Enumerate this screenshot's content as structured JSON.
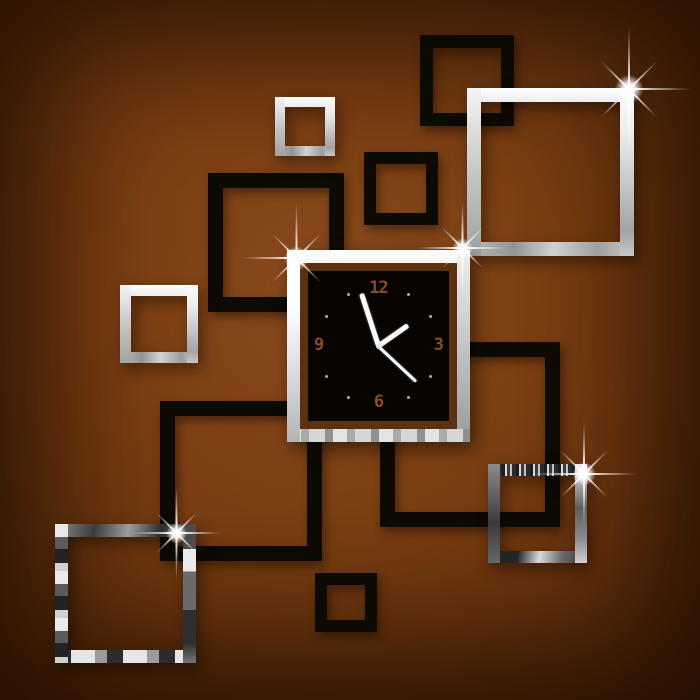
{
  "colors": {
    "wall_center": "#8a4a1d",
    "wall_corner": "#48220a",
    "black_frame": "#0d0903",
    "clock_face": "#080402",
    "clock_ring": "#5c3110",
    "digit": "#8e4c24",
    "hand": "#ffffff",
    "mirror_bright": "#ffffff",
    "mirror_mid": "#a8a8a8",
    "mirror_dark": "#2f2f2f"
  },
  "squares": [
    {
      "name": "black-square-top",
      "type": "black",
      "x": 420,
      "y": 35,
      "w": 94,
      "h": 91,
      "border": 13
    },
    {
      "name": "black-square-upper-mid",
      "type": "black",
      "x": 364,
      "y": 152,
      "w": 74,
      "h": 73,
      "border": 12
    },
    {
      "name": "black-square-left",
      "type": "black",
      "x": 208,
      "y": 173,
      "w": 136,
      "h": 139,
      "border": 15
    },
    {
      "name": "black-square-lower-left",
      "type": "black",
      "x": 160,
      "y": 401,
      "w": 162,
      "h": 160,
      "border": 15
    },
    {
      "name": "black-square-lower-right",
      "type": "black",
      "x": 380,
      "y": 342,
      "w": 180,
      "h": 185,
      "border": 15
    },
    {
      "name": "black-square-bottom-small",
      "type": "black",
      "x": 315,
      "y": 573,
      "w": 62,
      "h": 59,
      "border": 12
    },
    {
      "name": "mirror-square-small-top",
      "type": "mirror-light",
      "x": 275,
      "y": 97,
      "w": 60,
      "h": 59,
      "border": 10
    },
    {
      "name": "mirror-square-large",
      "type": "mirror-light",
      "x": 467,
      "y": 88,
      "w": 167,
      "h": 168,
      "border": 14
    },
    {
      "name": "mirror-square-left",
      "type": "mirror-light",
      "x": 120,
      "y": 285,
      "w": 78,
      "h": 78,
      "border": 11
    },
    {
      "name": "mirror-square-bottom-left",
      "type": "mirror-dark-a",
      "x": 55,
      "y": 524,
      "w": 141,
      "h": 139,
      "border": 13
    },
    {
      "name": "mirror-square-bottom-right",
      "type": "mirror-dark-b",
      "x": 488,
      "y": 464,
      "w": 99,
      "h": 99,
      "border": 12
    }
  ],
  "clock": {
    "x": 287,
    "y": 250,
    "w": 183,
    "h": 192,
    "frame_border": 13,
    "ring_border": 8,
    "digits": {
      "twelve": "12",
      "three": "3",
      "six": "6",
      "nine": "9"
    },
    "tick_angles": [
      30,
      60,
      120,
      150,
      210,
      240,
      300,
      330
    ],
    "tick_radius": 60,
    "hands": {
      "hour": {
        "angle_deg": 55,
        "length": 36,
        "width": 5
      },
      "minute": {
        "angle_deg": -18,
        "length": 55,
        "width": 5
      },
      "second": {
        "angle_deg": 133,
        "length": 52,
        "width": 2.5
      }
    },
    "time_reading": "~1:57"
  },
  "sparkles": [
    {
      "x": 629,
      "y": 89,
      "size": 130
    },
    {
      "x": 296,
      "y": 258,
      "size": 115
    },
    {
      "x": 462,
      "y": 248,
      "size": 95
    },
    {
      "x": 176,
      "y": 533,
      "size": 95
    },
    {
      "x": 584,
      "y": 474,
      "size": 110
    }
  ]
}
